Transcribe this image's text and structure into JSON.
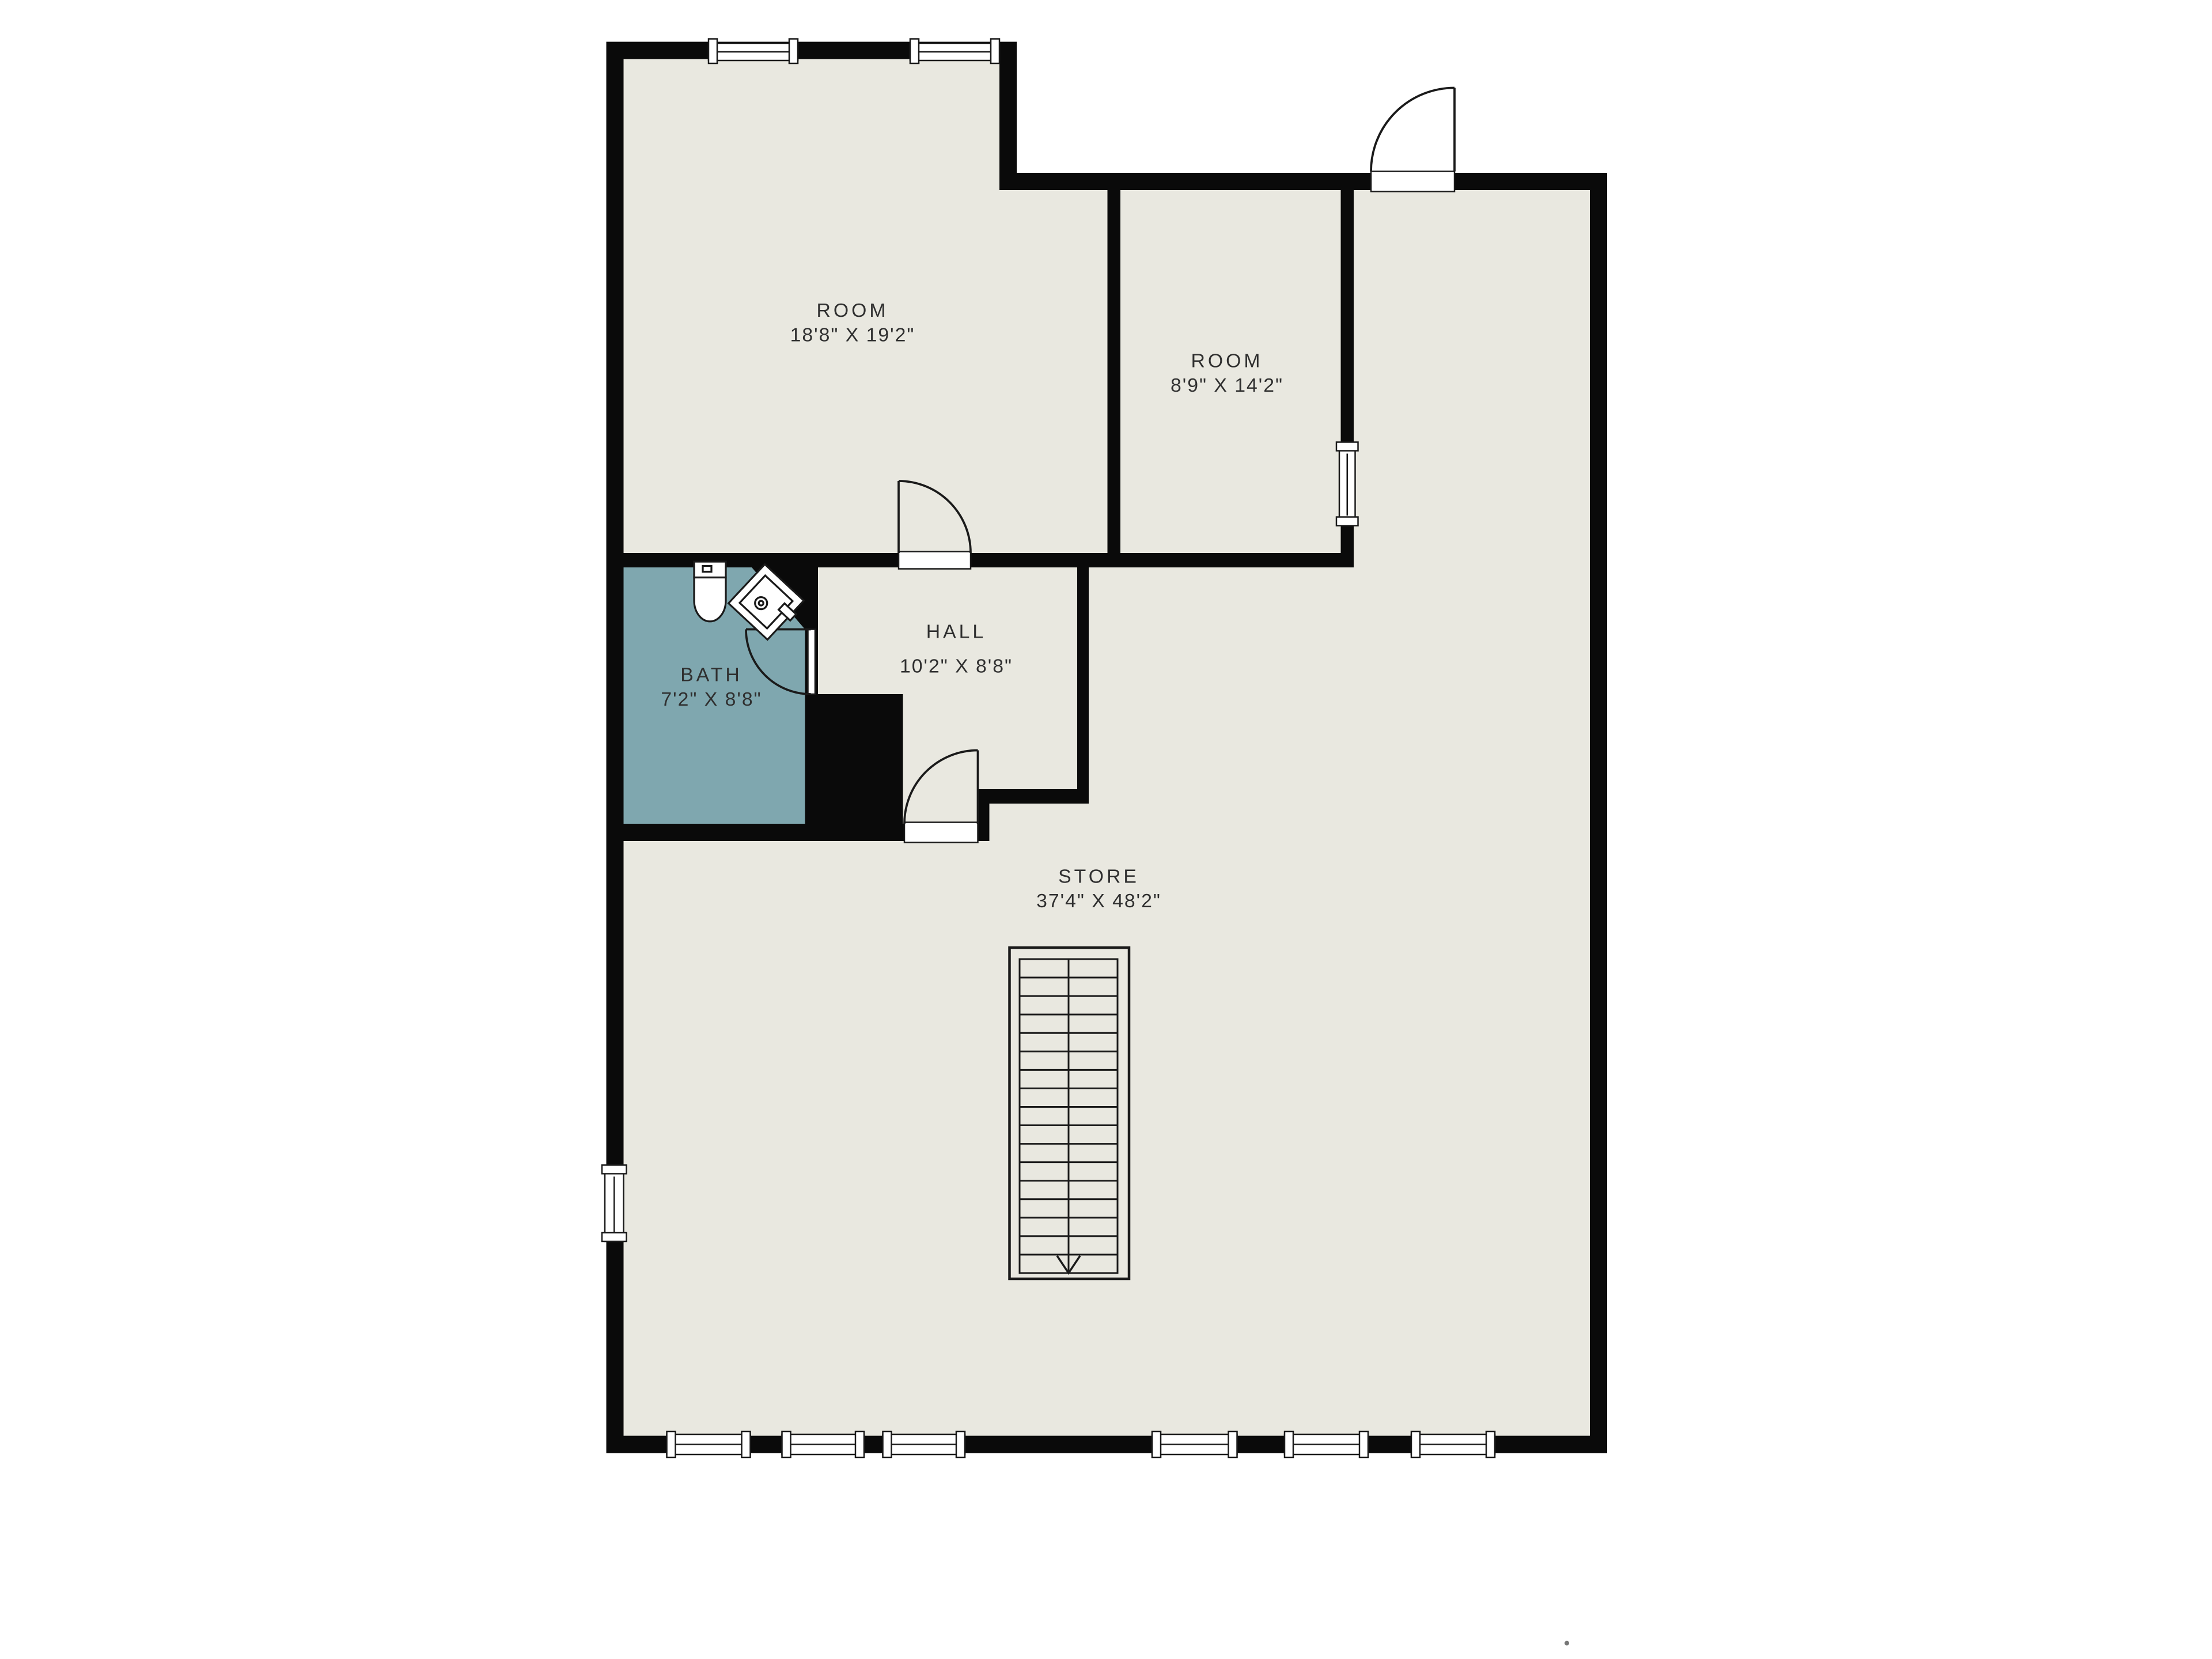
{
  "plan": {
    "rooms": [
      {
        "id": "room1",
        "name": "ROOM",
        "dims": "18'8\" X 19'2\""
      },
      {
        "id": "room2",
        "name": "ROOM",
        "dims": "8'9\" X 14'2\""
      },
      {
        "id": "hall",
        "name": "HALL",
        "dims": "10'2\" X 8'8\""
      },
      {
        "id": "bath",
        "name": "BATH",
        "dims": "7'2\" X 8'8\""
      },
      {
        "id": "store",
        "name": "STORE",
        "dims": "37'4\" X 48'2\""
      }
    ],
    "staircase": {
      "treads": 17,
      "direction": "down"
    },
    "fixtures": [
      "toilet",
      "sink"
    ]
  },
  "colors": {
    "background": "#ffffff",
    "floor": "#e9e8e0",
    "bath_floor": "#7fa7af",
    "wall": "#0a0a0a",
    "line": "#1a1a1a",
    "text": "#2f2f2f",
    "window_fill": "#ffffff"
  }
}
